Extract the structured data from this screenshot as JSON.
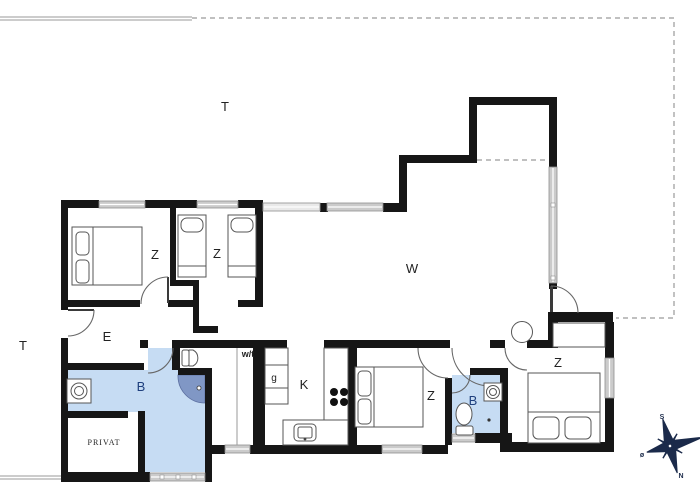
{
  "rooms": {
    "terrace_top": "T",
    "terrace_left": "T",
    "living": "W",
    "entry": "E",
    "bedroom_1": "Z",
    "bedroom_2": "Z",
    "bedroom_3": "Z",
    "bedroom_4": "Z",
    "bathroom_main": "B",
    "bathroom_ensuite": "B",
    "kitchen": "K",
    "utility": "w/t",
    "wardrobe": "g",
    "private": "PRIVAT"
  },
  "compass": {
    "south": "S",
    "north": "N",
    "east": "ø"
  },
  "colors": {
    "wall": "#161616",
    "bath_fill": "#c6dcf3",
    "shower_fill": "#8097c5",
    "window_fill": "#cbcbcb",
    "terrace_line": "#9a9a9a",
    "compass": "#1b2a4a",
    "bath_label": "#1e3f7d"
  }
}
